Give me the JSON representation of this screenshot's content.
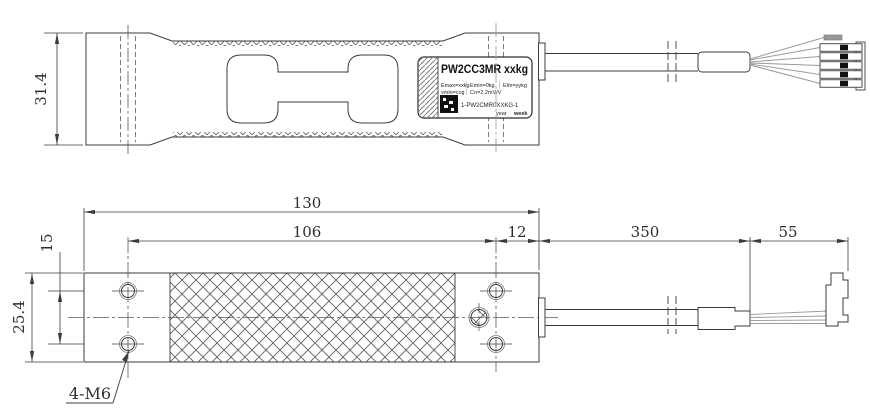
{
  "colors": {
    "line": "#3b3b3b",
    "thin_line": "#6e6e6e",
    "wire": "#9a9a9a",
    "qr": "#111111",
    "background": "#ffffff"
  },
  "top_view": {
    "height_dim": "31.4",
    "label": {
      "model": "PW2CC3MR xxkg",
      "specs_row1": [
        "Emax=xxkg",
        "Emin=0kg",
        "Elm=yykg"
      ],
      "specs_row2": [
        "vmin=ccg",
        "Cn=2.2mV/V"
      ],
      "serial_code": "1-PW2CMR0XXKG-1",
      "footer_year": "year",
      "footer_week": "week"
    }
  },
  "bottom_view": {
    "dims": {
      "overall_length": "130",
      "hole_span": "106",
      "hole_to_end": "12",
      "cable_length": "350",
      "wire_length": "55",
      "hole_pitch": "15",
      "body_width": "25.4"
    },
    "thread_callout": "4-M6"
  }
}
